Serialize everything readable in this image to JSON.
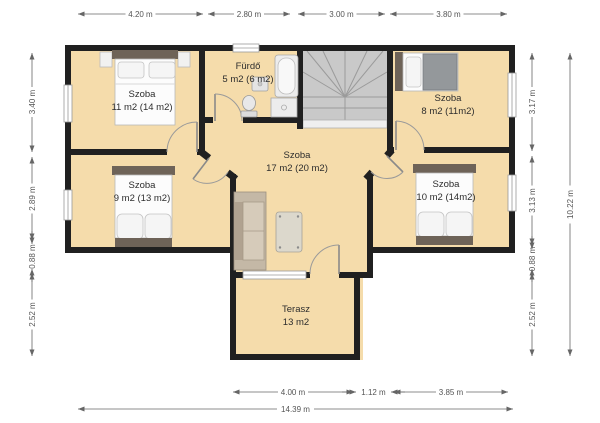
{
  "rooms": {
    "room11": {
      "name": "Szoba",
      "area": "11 m2 (14 m2)"
    },
    "bathroom": {
      "name": "Fürdő",
      "area": "5 m2 (6 m2)"
    },
    "room8": {
      "name": "Szoba",
      "area": "8 m2 (11m2)"
    },
    "hall": {
      "name": "Szoba",
      "area": "17 m2 (20 m2)"
    },
    "room9": {
      "name": "Szoba",
      "area": "9 m2 (13 m2)"
    },
    "room10": {
      "name": "Szoba",
      "area": "10 m2 (14m2)"
    },
    "terrace": {
      "name": "Terasz",
      "area": "13 m2"
    }
  },
  "dimensions": {
    "top": [
      "4.20 m",
      "2.80 m",
      "3.00 m",
      "3.80 m"
    ],
    "left": [
      "3.40 m",
      "2.89 m",
      "0.88 m",
      "2.52 m"
    ],
    "right": [
      "3.17 m",
      "3.13 m",
      "0.88 m",
      "2.52 m"
    ],
    "right_total": "10.22 m",
    "bottom": [
      "4.00 m",
      "1.12 m",
      "3.85 m"
    ],
    "bottom_total": "14.39 m"
  },
  "colors": {
    "floor": "#f5dcab",
    "wall": "#202020",
    "stairs": "#c9c9c9"
  }
}
